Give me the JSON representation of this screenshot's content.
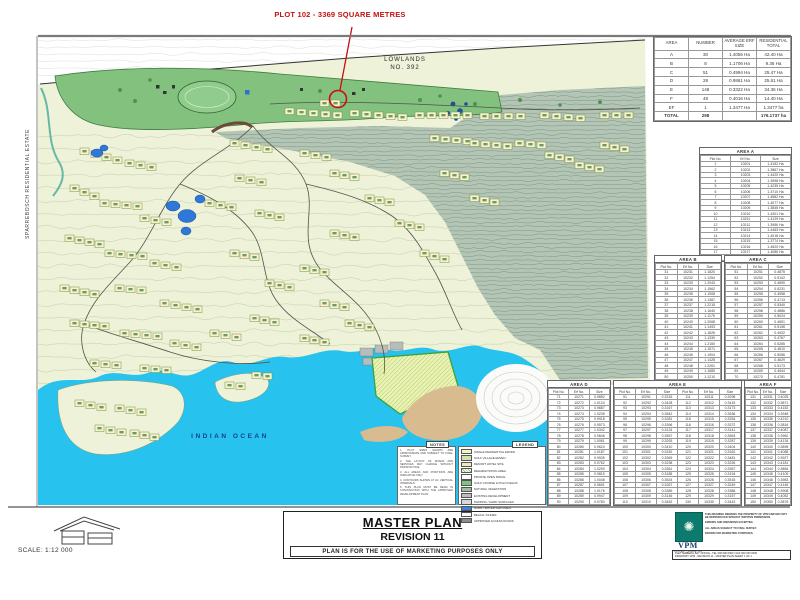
{
  "annotation": {
    "text": "PLOT 102 - 3369 SQUARE METRES"
  },
  "map_labels": {
    "lowlands_line1": "LOWLANDS",
    "lowlands_line2": "NO. 392",
    "ocean": "INDIAN OCEAN",
    "estate_vertical": "SPARREBOSCH RESIDENTIAL ESTATE"
  },
  "tables": {
    "summary": {
      "headers": [
        "AREA",
        "NUMBER",
        "AVERAGE ERF SIZE",
        "RESIDENTIAL TOTAL"
      ],
      "rows": [
        [
          "A",
          "30",
          "1.4056 Ha",
          "42.40 Ha"
        ],
        [
          "B",
          "8",
          "1.1706 Ha",
          "9.36 Ha"
        ],
        [
          "C",
          "51",
          "0.4994 Ha",
          "25.47 Ha"
        ],
        [
          "D",
          "28",
          "0.9861 Ha",
          "25.61 Ha"
        ],
        [
          "E",
          "148",
          "0.3322 Ha",
          "34.36 Ha"
        ],
        [
          "F",
          "48",
          "0.4016 Ha",
          "14.40 Ha"
        ],
        [
          "EF",
          "1",
          "1.3477 Ha",
          "1.3477 ha"
        ]
      ],
      "total": [
        "TOTAL",
        "298",
        "",
        "176.1737 ha"
      ]
    },
    "a": {
      "title": "AREA A",
      "headers": [
        "Plot No.",
        "Erf No.",
        "Size"
      ],
      "rows": [
        [
          "1",
          "10201",
          "1.4152 Ha"
        ],
        [
          "2",
          "10202",
          "1.3867 Ha"
        ],
        [
          "3",
          "10203",
          "1.4420 Ha"
        ],
        [
          "4",
          "10204",
          "1.3998 Ha"
        ],
        [
          "5",
          "10205",
          "1.4235 Ha"
        ],
        [
          "6",
          "10206",
          "1.3710 Ha"
        ],
        [
          "7",
          "10207",
          "1.4582 Ha"
        ],
        [
          "8",
          "10208",
          "1.4077 Ha"
        ],
        [
          "9",
          "10209",
          "1.3845 Ha"
        ],
        [
          "10",
          "10210",
          "1.4301 Ha"
        ],
        [
          "11",
          "10211",
          "1.4129 Ha"
        ],
        [
          "12",
          "10212",
          "1.3956 Ha"
        ],
        [
          "13",
          "10213",
          "1.4463 Ha"
        ],
        [
          "14",
          "10214",
          "1.4018 Ha"
        ],
        [
          "15",
          "10215",
          "1.3774 Ha"
        ],
        [
          "16",
          "10216",
          "1.4520 Ha"
        ],
        [
          "17",
          "10217",
          "1.4086 Ha"
        ],
        [
          "18",
          "10218",
          "1.3912 Ha"
        ]
      ]
    },
    "b": {
      "title": "AREA B",
      "headers": [
        "Plot No.",
        "Erf No.",
        "Size"
      ],
      "rows": [
        [
          "31",
          "10231",
          "1.1820"
        ],
        [
          "32",
          "10232",
          "1.1254"
        ],
        [
          "33",
          "10233",
          "1.2043"
        ],
        [
          "34",
          "10234",
          "1.1562"
        ],
        [
          "35",
          "10235",
          "1.1908"
        ],
        [
          "36",
          "10236",
          "1.1387"
        ],
        [
          "37",
          "10237",
          "1.2215"
        ],
        [
          "38",
          "10238",
          "1.1640"
        ],
        [
          "39",
          "10239",
          "1.1175"
        ],
        [
          "40",
          "10240",
          "1.2068"
        ],
        [
          "41",
          "10241",
          "1.1493"
        ],
        [
          "42",
          "10242",
          "1.1826"
        ],
        [
          "43",
          "10243",
          "1.1339"
        ],
        [
          "44",
          "10244",
          "1.2150"
        ],
        [
          "45",
          "10245",
          "1.1571"
        ],
        [
          "46",
          "10246",
          "1.1904"
        ],
        [
          "47",
          "10247",
          "1.1428"
        ],
        [
          "48",
          "10248",
          "1.2261"
        ],
        [
          "49",
          "10249",
          "1.1685"
        ],
        [
          "50",
          "10250",
          "1.1210"
        ]
      ]
    },
    "c": {
      "title": "AREA C",
      "headers": [
        "Plot No.",
        "Erf No.",
        "Size"
      ],
      "rows": [
        [
          "51",
          "10251",
          "0.4875"
        ],
        [
          "52",
          "10252",
          "0.5102"
        ],
        [
          "53",
          "10253",
          "0.4690"
        ],
        [
          "54",
          "10254",
          "0.5231"
        ],
        [
          "55",
          "10255",
          "0.4958"
        ],
        [
          "56",
          "10256",
          "0.4713"
        ],
        [
          "57",
          "10257",
          "0.5340"
        ],
        [
          "58",
          "10258",
          "0.4886"
        ],
        [
          "59",
          "10259",
          "0.5024"
        ],
        [
          "60",
          "10260",
          "0.4651"
        ],
        [
          "61",
          "10261",
          "0.5198"
        ],
        [
          "62",
          "10262",
          "0.4932"
        ],
        [
          "63",
          "10263",
          "0.4767"
        ],
        [
          "64",
          "10264",
          "0.5285"
        ],
        [
          "65",
          "10265",
          "0.4810"
        ],
        [
          "66",
          "10266",
          "0.5056"
        ],
        [
          "67",
          "10267",
          "0.4629"
        ],
        [
          "68",
          "10268",
          "0.5173"
        ],
        [
          "69",
          "10269",
          "0.4944"
        ],
        [
          "70",
          "10270",
          "0.4781"
        ]
      ]
    },
    "d": {
      "title": "AREA D",
      "headers": [
        "Plot No.",
        "Erf No.",
        "Size"
      ],
      "rows": [
        [
          "71",
          "10271",
          "0.9852"
        ],
        [
          "72",
          "10272",
          "1.0124"
        ],
        [
          "73",
          "10273",
          "0.9687"
        ],
        [
          "74",
          "10274",
          "1.0235"
        ],
        [
          "75",
          "10275",
          "0.9918"
        ],
        [
          "76",
          "10276",
          "0.9573"
        ],
        [
          "77",
          "10277",
          "1.0342"
        ],
        [
          "78",
          "10278",
          "0.9846"
        ],
        [
          "79",
          "10279",
          "1.0061"
        ],
        [
          "80",
          "10280",
          "0.9624"
        ],
        [
          "81",
          "10281",
          "1.0187"
        ],
        [
          "82",
          "10282",
          "0.9935"
        ],
        [
          "83",
          "10283",
          "0.9762"
        ],
        [
          "84",
          "10284",
          "1.0293"
        ],
        [
          "85",
          "10285",
          "0.9815"
        ],
        [
          "86",
          "10286",
          "1.0048"
        ],
        [
          "87",
          "10287",
          "0.9691"
        ],
        [
          "88",
          "10288",
          "1.0176"
        ],
        [
          "89",
          "10289",
          "0.9947"
        ],
        [
          "90",
          "10290",
          "0.9783"
        ]
      ]
    },
    "e": {
      "title": "AREA E",
      "headers": [
        "Plot No.",
        "Erf No.",
        "Size",
        "Plot No.",
        "Erf No.",
        "Size"
      ],
      "rows": [
        [
          "91",
          "10291",
          "0.3315",
          "111",
          "10311",
          "0.3298"
        ],
        [
          "92",
          "10292",
          "0.3428",
          "112",
          "10312",
          "0.3415"
        ],
        [
          "93",
          "10293",
          "0.3167",
          "113",
          "10313",
          "0.3173"
        ],
        [
          "94",
          "10294",
          "0.3542",
          "114",
          "10314",
          "0.3536"
        ],
        [
          "95",
          "10295",
          "0.3281",
          "115",
          "10315",
          "0.3254"
        ],
        [
          "96",
          "10296",
          "0.3396",
          "116",
          "10316",
          "0.3372"
        ],
        [
          "97",
          "10297",
          "0.3124",
          "117",
          "10317",
          "0.3141"
        ],
        [
          "98",
          "10298",
          "0.3557",
          "118",
          "10318",
          "0.3563"
        ],
        [
          "99",
          "10299",
          "0.3293",
          "119",
          "10319",
          "0.3287"
        ],
        [
          "100",
          "10300",
          "0.3410",
          "120",
          "10320",
          "0.3404"
        ],
        [
          "101",
          "10301",
          "0.3152",
          "121",
          "10321",
          "0.3162"
        ],
        [
          "102",
          "10302",
          "0.3369",
          "122",
          "10322",
          "0.3481"
        ],
        [
          "103",
          "10303",
          "0.3238",
          "123",
          "10323",
          "0.3226"
        ],
        [
          "104",
          "10304",
          "0.3361",
          "124",
          "10324",
          "0.3357"
        ],
        [
          "105",
          "10305",
          "0.3185",
          "125",
          "10325",
          "0.3194"
        ],
        [
          "106",
          "10306",
          "0.3524",
          "126",
          "10326",
          "0.3518"
        ],
        [
          "107",
          "10307",
          "0.3267",
          "127",
          "10327",
          "0.3249"
        ],
        [
          "108",
          "10308",
          "0.3389",
          "128",
          "10328",
          "0.3386"
        ],
        [
          "109",
          "10309",
          "0.3146",
          "129",
          "10329",
          "0.3157"
        ],
        [
          "110",
          "10310",
          "0.3452",
          "130",
          "10330",
          "0.3443"
        ]
      ]
    },
    "f": {
      "title": "AREA F",
      "headers": [
        "Plot No.",
        "Erf No.",
        "Size"
      ],
      "rows": [
        [
          "131",
          "10331",
          "0.4025"
        ],
        [
          "132",
          "10332",
          "0.3871"
        ],
        [
          "133",
          "10333",
          "0.4152"
        ],
        [
          "134",
          "10334",
          "0.3948"
        ],
        [
          "135",
          "10335",
          "0.4210"
        ],
        [
          "136",
          "10336",
          "0.3816"
        ],
        [
          "137",
          "10337",
          "0.4087"
        ],
        [
          "138",
          "10338",
          "0.3962"
        ],
        [
          "139",
          "10339",
          "0.4134"
        ],
        [
          "140",
          "10340",
          "0.3895"
        ],
        [
          "141",
          "10341",
          "0.4068"
        ],
        [
          "142",
          "10342",
          "0.3927"
        ],
        [
          "143",
          "10343",
          "0.4181"
        ],
        [
          "144",
          "10344",
          "0.3854"
        ],
        [
          "145",
          "10345",
          "0.4109"
        ],
        [
          "146",
          "10346",
          "0.3983"
        ],
        [
          "147",
          "10347",
          "0.4146"
        ],
        [
          "148",
          "10348",
          "0.3908"
        ],
        [
          "149",
          "10349",
          "0.4052"
        ],
        [
          "150",
          "10350",
          "0.3876"
        ]
      ]
    }
  },
  "notes": {
    "title": "NOTES",
    "items": [
      "PLOT SIZES SHOWN ARE APPROXIMATE AND SUBJECT TO FINAL SURVEY.",
      "THE LAYOUT OF ROADS AND SERVICES MAY CHANGE WITHOUT PRIOR NOTICE.",
      "ALL AREAS AND POSITIONS ARE INDICATIVE ONLY.",
      "CONTOURS SHOWN AT 2m VERTICAL INTERVALS.",
      "THIS PLAN MUST BE READ IN CONJUNCTION WITH THE APPROVED DEVELOPMENT PLAN."
    ]
  },
  "legend": {
    "title": "LEGEND",
    "items": [
      {
        "label": "SINGLE RESIDENTIAL ERVEN",
        "color": "#f6f1c6"
      },
      {
        "label": "GOLF VILLAGE ERVEN",
        "color": "#cfe3a8"
      },
      {
        "label": "RESORT HOTEL SITE",
        "color": "#efe9bd"
      },
      {
        "label": "REHABILITATION AREA",
        "color": "#f6f1c6",
        "hatch": true
      },
      {
        "label": "PRIVATE OPEN SPACE",
        "color": "#ffffff"
      },
      {
        "label": "GOLF COURSE & POLO FIELDS",
        "color": "#7cc47f"
      },
      {
        "label": "NATURAL VEGETATION",
        "color": "#a3b8a6"
      },
      {
        "label": "EXISTING DEVELOPMENT",
        "color": "#bdbdbd"
      },
      {
        "label": "PARKING / HARD SURFACES",
        "color": "#d8d8d8"
      },
      {
        "label": "DAMS / WATER FEATURES",
        "color": "#3a84e0"
      },
      {
        "label": "BEACH / DUNES",
        "color": "#fbfbf5"
      },
      {
        "label": "APPROVED ACCESS ROADS",
        "color": "#8c8c8c"
      }
    ]
  },
  "title_block": {
    "title": "MASTER PLAN",
    "revision": "REVISION 11",
    "disclaimer": "PLAN IS FOR THE USE OF MARKETING PURPOSES ONLY"
  },
  "scale": {
    "label": "SCALE: 1:12 000"
  },
  "vpm": {
    "name": "VPM",
    "caption": "PROPERTY MARKETING",
    "lines": [
      "THIS DRAWING REMAINS THE PROPERTY OF VPM AND MAY NOT BE REPRODUCED WITHOUT WRITTEN PERMISSION.",
      "ERRORS AND OMISSIONS EXCEPTED.",
      "ALL AREAS SUBJECT TO FINAL SURVEY.",
      "DRAWN FOR MARKETING PURPOSES."
    ],
    "contact_line1": "PLETTENBERG BAY OFFICE - TEL 000 000 0000 / FAX 000 000 0000",
    "contact_line2": "DRAWN BY VPM - REVISION 11 - MASTER PLAN SHEET 1 OF 1"
  }
}
